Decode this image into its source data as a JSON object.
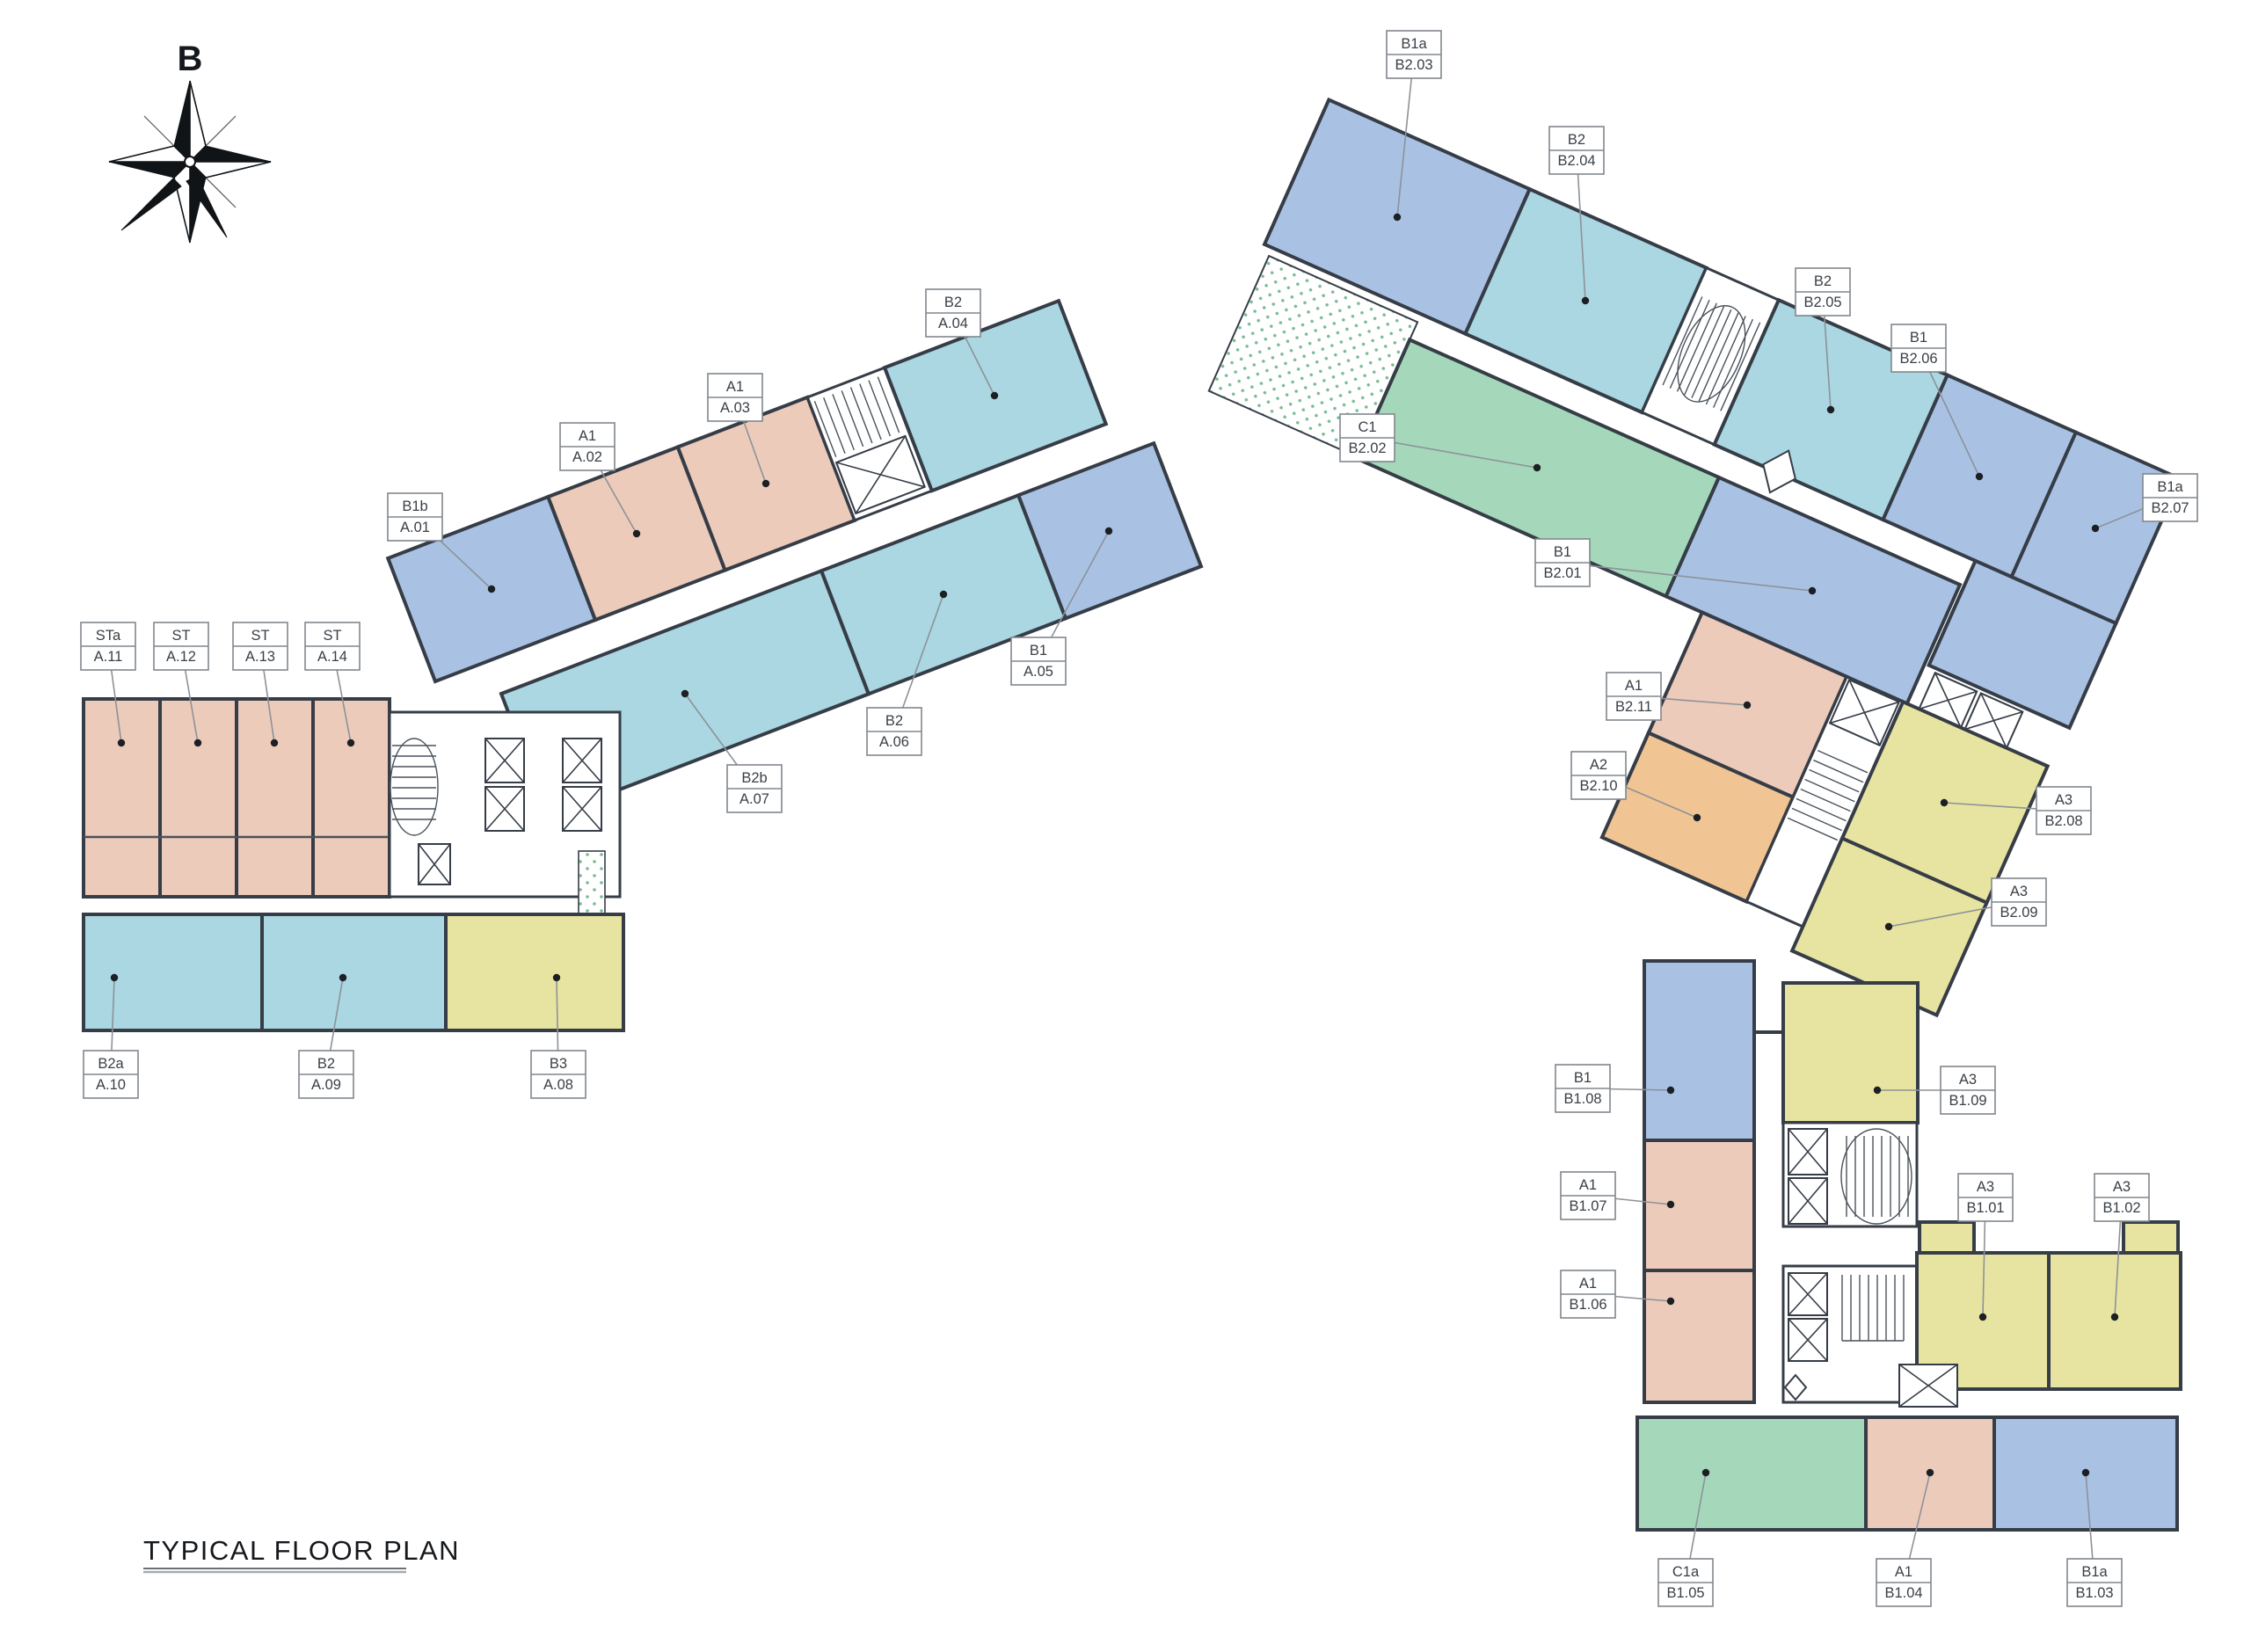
{
  "title": "TYPICAL FLOOR PLAN",
  "compass": {
    "north_label": "B"
  },
  "palette": {
    "salmon": "#eccbbb",
    "blue": "#a9c2e4",
    "cyan": "#aad7e2",
    "yellow": "#e7e4a2",
    "green": "#a5d8ba",
    "orange": "#f0c493",
    "terrace_dot": "#79bb93",
    "wall": "#363d47",
    "leader": "#8d9298",
    "callout_text": "#3a4046"
  },
  "blocks": {
    "block_a": {
      "units": [
        {
          "type": "B1b",
          "id": "A.01",
          "color": "blue"
        },
        {
          "type": "A1",
          "id": "A.02",
          "color": "salmon"
        },
        {
          "type": "A1",
          "id": "A.03",
          "color": "salmon"
        },
        {
          "type": "B2",
          "id": "A.04",
          "color": "cyan"
        },
        {
          "type": "B1",
          "id": "A.05",
          "color": "blue"
        },
        {
          "type": "B2",
          "id": "A.06",
          "color": "cyan"
        },
        {
          "type": "B2b",
          "id": "A.07",
          "color": "cyan"
        },
        {
          "type": "B3",
          "id": "A.08",
          "color": "yellow"
        },
        {
          "type": "B2",
          "id": "A.09",
          "color": "cyan"
        },
        {
          "type": "B2a",
          "id": "A.10",
          "color": "cyan"
        },
        {
          "type": "STa",
          "id": "A.11",
          "color": "salmon"
        },
        {
          "type": "ST",
          "id": "A.12",
          "color": "salmon"
        },
        {
          "type": "ST",
          "id": "A.13",
          "color": "salmon"
        },
        {
          "type": "ST",
          "id": "A.14",
          "color": "salmon"
        }
      ]
    },
    "block_b2": {
      "units": [
        {
          "type": "B1",
          "id": "B2.01",
          "color": "blue"
        },
        {
          "type": "C1",
          "id": "B2.02",
          "color": "green"
        },
        {
          "type": "B1a",
          "id": "B2.03",
          "color": "blue"
        },
        {
          "type": "B2",
          "id": "B2.04",
          "color": "cyan"
        },
        {
          "type": "B2",
          "id": "B2.05",
          "color": "cyan"
        },
        {
          "type": "B1",
          "id": "B2.06",
          "color": "blue"
        },
        {
          "type": "B1a",
          "id": "B2.07",
          "color": "blue"
        },
        {
          "type": "A3",
          "id": "B2.08",
          "color": "yellow"
        },
        {
          "type": "A3",
          "id": "B2.09",
          "color": "yellow"
        },
        {
          "type": "A2",
          "id": "B2.10",
          "color": "orange"
        },
        {
          "type": "A1",
          "id": "B2.11",
          "color": "salmon"
        }
      ]
    },
    "block_b1": {
      "units": [
        {
          "type": "A3",
          "id": "B1.01",
          "color": "yellow"
        },
        {
          "type": "A3",
          "id": "B1.02",
          "color": "yellow"
        },
        {
          "type": "B1a",
          "id": "B1.03",
          "color": "blue"
        },
        {
          "type": "A1",
          "id": "B1.04",
          "color": "salmon"
        },
        {
          "type": "C1a",
          "id": "B1.05",
          "color": "green"
        },
        {
          "type": "A1",
          "id": "B1.06",
          "color": "salmon"
        },
        {
          "type": "A1",
          "id": "B1.07",
          "color": "salmon"
        },
        {
          "type": "B1",
          "id": "B1.08",
          "color": "blue"
        },
        {
          "type": "A3",
          "id": "B1.09",
          "color": "yellow"
        }
      ]
    }
  }
}
